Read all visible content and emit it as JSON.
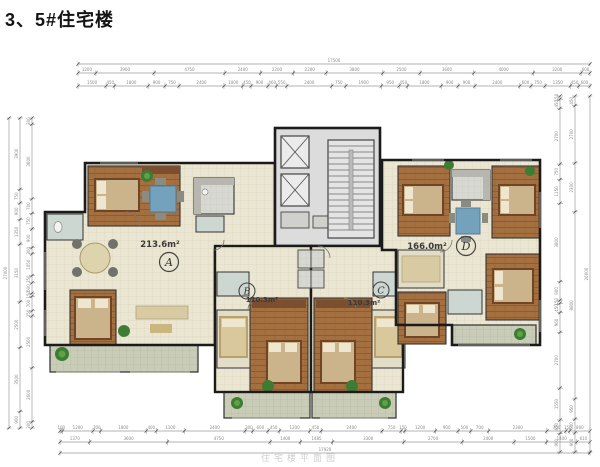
{
  "page": {
    "title": "3、5#住宅楼",
    "caption": "住宅楼平面图"
  },
  "units": [
    {
      "letter": "A",
      "area": "213.6m²"
    },
    {
      "letter": "B",
      "area": "110.3m²"
    },
    {
      "letter": "C",
      "area": "110.3m²"
    },
    {
      "letter": "D",
      "area": "166.0m²"
    }
  ],
  "colors": {
    "wall": "#1b1b1b",
    "tile_floor": "#eae6d3",
    "wood_floor": "#a5703f",
    "balcony": "#c9ccb7",
    "core_gray": "#dcdcdc",
    "accent_blue": "#74a2bc",
    "plant_green": "#3e7c33",
    "dimension_gray": "#8a8a8a"
  },
  "dimensions": {
    "rows": [
      {
        "o": "h",
        "p": 64,
        "a": 78,
        "b": 590,
        "g": 2.5,
        "vals": [
          "17500"
        ]
      },
      {
        "o": "h",
        "p": 73,
        "a": 78,
        "b": 590,
        "g": 3,
        "vals": [
          "1200",
          "3900",
          "4750",
          "2400",
          "2200",
          "2200",
          "3800",
          "2500",
          "3600",
          "4000",
          "3200",
          "600"
        ]
      },
      {
        "o": "h",
        "p": 86,
        "a": 78,
        "b": 590,
        "g": 3,
        "vals": [
          "1500",
          "450",
          "1800",
          "900",
          "750",
          "2400",
          "1000",
          "450",
          "900",
          "460",
          "550",
          "2400",
          "750",
          "1900",
          "950",
          "450",
          "1800",
          "900",
          "900",
          "2400",
          "600",
          "750",
          "1350",
          "450",
          "600"
        ]
      },
      {
        "o": "h",
        "p": 431,
        "a": 60,
        "b": 590,
        "g": 3,
        "vals": [
          "100",
          "1200",
          "300",
          "1800",
          "400",
          "1100",
          "2400",
          "300",
          "600",
          "450",
          "1200",
          "450",
          "2400",
          "750",
          "150",
          "1200",
          "900",
          "500",
          "700",
          "2300",
          "750",
          "150",
          "800"
        ]
      },
      {
        "o": "h",
        "p": 442,
        "a": 60,
        "b": 590,
        "g": 3,
        "vals": [
          "1370",
          "3600",
          "4750",
          "1400",
          "1485",
          "3300",
          "2700",
          "2400",
          "1500",
          "1400",
          "610"
        ]
      },
      {
        "o": "h",
        "p": 453,
        "a": 60,
        "b": 590,
        "g": 2.5,
        "vals": [
          "17920"
        ]
      },
      {
        "o": "v",
        "p": 9,
        "a": 118,
        "b": 428,
        "g": 2.5,
        "vals": [
          "27000"
        ]
      },
      {
        "o": "v",
        "p": 20,
        "a": 118,
        "b": 428,
        "g": 3,
        "vals": [
          "3900",
          "750",
          "900",
          "1350",
          "3150",
          "2500",
          "3500",
          "900"
        ]
      },
      {
        "o": "v",
        "p": 32,
        "a": 118,
        "b": 428,
        "g": 3,
        "vals": [
          "300",
          "3600",
          "700",
          "750",
          "900",
          "300",
          "1050",
          "350",
          "500",
          "150",
          "700",
          "250",
          "2500",
          "2600",
          "300"
        ]
      },
      {
        "o": "v",
        "p": 560,
        "a": 96,
        "b": 452,
        "g": 3,
        "vals": [
          "150",
          "450",
          "2700",
          "750",
          "1150",
          "3800",
          "900",
          "150",
          "450",
          "960",
          "2700",
          "1550",
          "650",
          "900"
        ]
      },
      {
        "o": "v",
        "p": 575,
        "a": 96,
        "b": 452,
        "g": 3,
        "vals": [
          "450",
          "2700",
          "2300",
          "8800",
          "950",
          "650",
          "900"
        ]
      },
      {
        "o": "v",
        "p": 590,
        "a": 96,
        "b": 452,
        "g": 2.5,
        "vals": [
          "26000"
        ]
      }
    ]
  }
}
